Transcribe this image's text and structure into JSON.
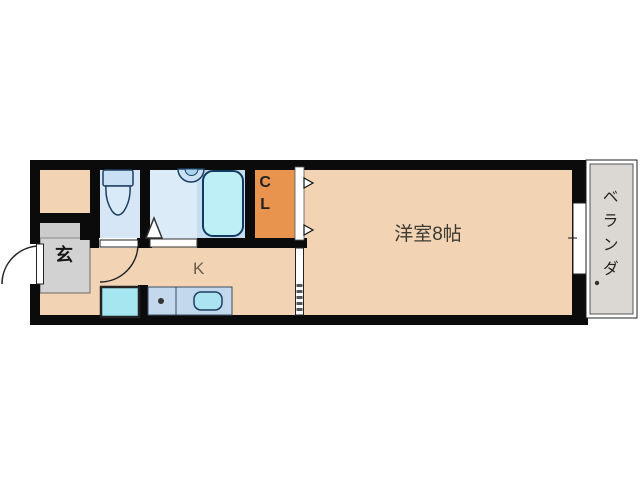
{
  "floor_plan": {
    "labels": {
      "western_room": "洋室8帖",
      "kitchen": "K",
      "closet": "CL",
      "entrance": "玄",
      "veranda": "ベランダ"
    },
    "colors": {
      "floor": "#F2D4B5",
      "toilet_room_floor": "#D6E6F7",
      "bath_floor": "#DCEBF8",
      "bath_tub_zone": "#C6DDF1",
      "closet_fill": "#E8944E",
      "entrance_fill": "#D2D2D2",
      "entrance_step_fill": "#CBCBCB",
      "veranda_fill": "#DBD7D3",
      "bathtub_fill": "#BEEFF6",
      "washbasin_fill": "#CBE2F5",
      "toilet_fill": "#C9E0F4",
      "washer_pan_fill": "#A5E6F0",
      "counter_fill": "#C3D8EC",
      "sink_fill": "#ACE3F2",
      "wall": "#0B0B0B"
    }
  }
}
